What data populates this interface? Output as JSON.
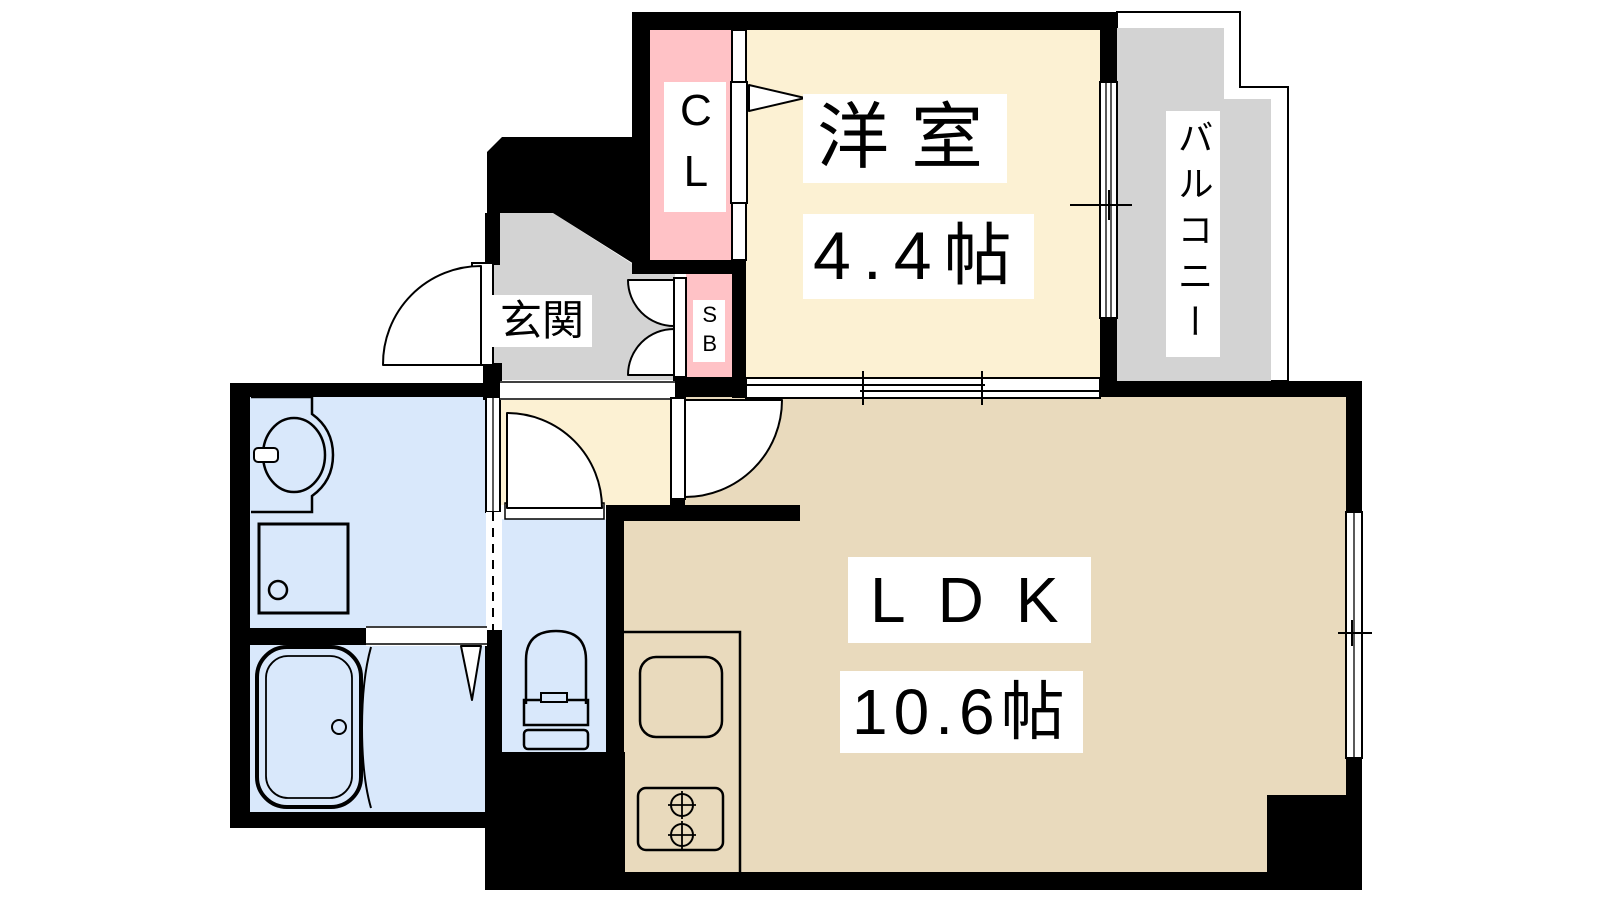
{
  "plan": {
    "type": "japanese-apartment-floor-plan",
    "rooms": {
      "closet": {
        "label": "CL"
      },
      "shoe_box": {
        "label": "SB"
      },
      "entrance": {
        "label": "玄関"
      },
      "western_room": {
        "label": "洋室",
        "size": "4.4帖"
      },
      "balcony": {
        "label": "バルコニー"
      },
      "ldk": {
        "label": "LDK",
        "size": "10.6帖"
      },
      "washroom": {
        "label": ""
      },
      "bathroom": {
        "label": ""
      },
      "toilet": {
        "label": ""
      }
    },
    "fixtures": [
      "bathtub",
      "bath-door-curve",
      "washbasin",
      "faucet",
      "washing-machine-pan",
      "toilet-bowl",
      "kitchen-counter",
      "kitchen-sink",
      "gas-stove-2-burner",
      "entrance-door-swing",
      "shoebox-double-doors",
      "closet-folding-door-marker",
      "toilet-door-swing",
      "ldk-door-swing",
      "sliding-partition",
      "sliding-windows"
    ],
    "colors": {
      "wall": "#000000",
      "cream": "#fcf1d3",
      "tan": "#e9dabd",
      "pink": "#ffc2c6",
      "gray": "#d3d3d3",
      "blue": "#d9e8fb",
      "label_bg": "#ffffff",
      "label_text": "#000000",
      "line": "#000000"
    }
  }
}
